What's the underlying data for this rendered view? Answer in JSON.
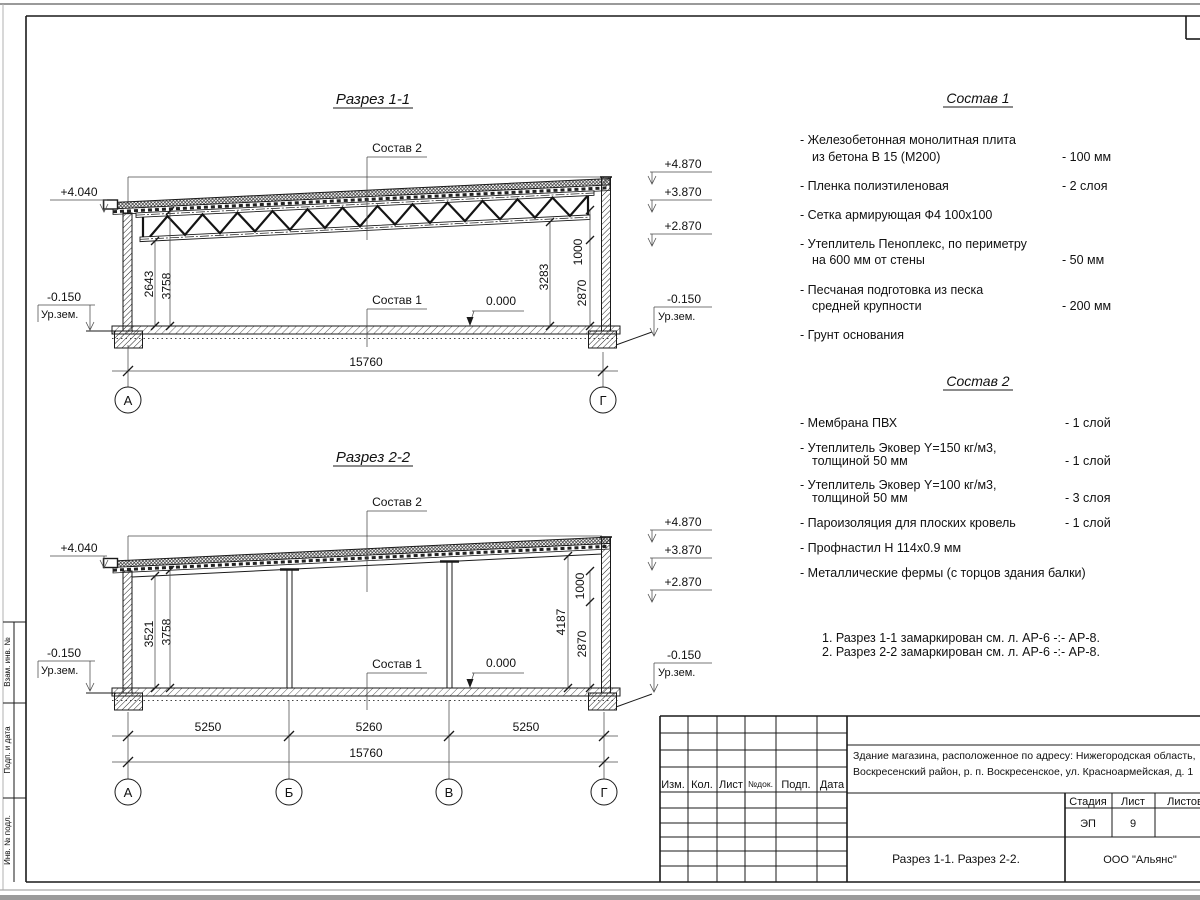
{
  "section1": {
    "title": "Разрез 1-1",
    "label_roof": "Состав 2",
    "label_floor": "Состав 1",
    "zero_mark": "0.000",
    "elev_left_top": "+4.040",
    "elev_left_ground": "-0.150",
    "ground_label": "Ур.зем.",
    "elev_right": [
      "+4.870",
      "+3.870",
      "+2.870"
    ],
    "elev_right_ground": "-0.150",
    "dims_left": [
      "2643",
      "3758"
    ],
    "dims_right": [
      "3283",
      "1000",
      "2870"
    ],
    "dim_overall": "15760",
    "axis_left": "А",
    "axis_right": "Г"
  },
  "section2": {
    "title": "Разрез 2-2",
    "label_roof": "Состав 2",
    "label_floor": "Состав 1",
    "zero_mark": "0.000",
    "elev_left_top": "+4.040",
    "elev_left_ground": "-0.150",
    "ground_label": "Ур.зем.",
    "elev_right": [
      "+4.870",
      "+3.870",
      "+2.870"
    ],
    "elev_right_ground": "-0.150",
    "dims_left": [
      "3521",
      "3758"
    ],
    "dims_right": [
      "4187",
      "1000",
      "2870"
    ],
    "dims_span": [
      "5250",
      "5260",
      "5250"
    ],
    "dim_overall": "15760",
    "axes": [
      "А",
      "Б",
      "В",
      "Г"
    ]
  },
  "spec1": {
    "title": "Состав 1",
    "items": [
      {
        "l1": "- Железобетонная  монолитная плита",
        "l2": "из бетона В 15 (М200)",
        "v": "- 100 мм"
      },
      {
        "l1": "- Пленка полиэтиленовая",
        "l2": "",
        "v": "-  2 слоя"
      },
      {
        "l1": "- Сетка армирующая Ф4 100х100",
        "l2": "",
        "v": ""
      },
      {
        "l1": "- Утеплитель Пеноплекс, по периметру",
        "l2": "на 600 мм от стены",
        "v": "- 50 мм"
      },
      {
        "l1": "- Песчаная подготовка из песка",
        "l2": "средней крупности",
        "v": "- 200 мм"
      },
      {
        "l1": "- Грунт основания",
        "l2": "",
        "v": ""
      }
    ]
  },
  "spec2": {
    "title": "Состав 2",
    "items": [
      {
        "l1": "- Мембрана ПВХ",
        "l2": "",
        "v": "- 1 слой"
      },
      {
        "l1": "- Утеплитель Эковер Y=150 кг/м3,",
        "l2": "толщиной 50 мм",
        "v": "- 1 слой"
      },
      {
        "l1": "- Утеплитель Эковер Y=100 кг/м3,",
        "l2": "толщиной 50 мм",
        "v": "- 3 слоя"
      },
      {
        "l1": "- Пароизоляция для плоских кровель",
        "l2": "",
        "v": "- 1 слой"
      },
      {
        "l1": "- Профнастил Н 114х0.9 мм",
        "l2": "",
        "v": ""
      },
      {
        "l1": "- Металлические фермы (с торцов здания балки)",
        "l2": "",
        "v": ""
      }
    ]
  },
  "notes": [
    "1. Разрез 1-1 замаркирован см. л. АР-6 -:- АР-8.",
    "2. Разрез 2-2 замаркирован см. л. АР-6 -:- АР-8."
  ],
  "titleblock": {
    "cols": [
      "Изм.",
      "Кол.",
      "Лист",
      "№док.",
      "Подп.",
      "Дата"
    ],
    "object_line1": "Здание магазина, расположенное по адресу: Нижегородская область,",
    "object_line2": "Воскресенский район, р. п. Воскресенское, ул. Красноармейская, д. 1",
    "stage_label": "Стадия",
    "sheet_label": "Лист",
    "sheets_label": "Листов",
    "stage": "ЭП",
    "sheet_no": "9",
    "doc_title": "Разрез 1-1. Разрез 2-2.",
    "company": "ООО \"Альянс\""
  },
  "side_stamp": [
    "Взам. инв. №",
    "Подп. и дата",
    "Инв. № подл."
  ]
}
